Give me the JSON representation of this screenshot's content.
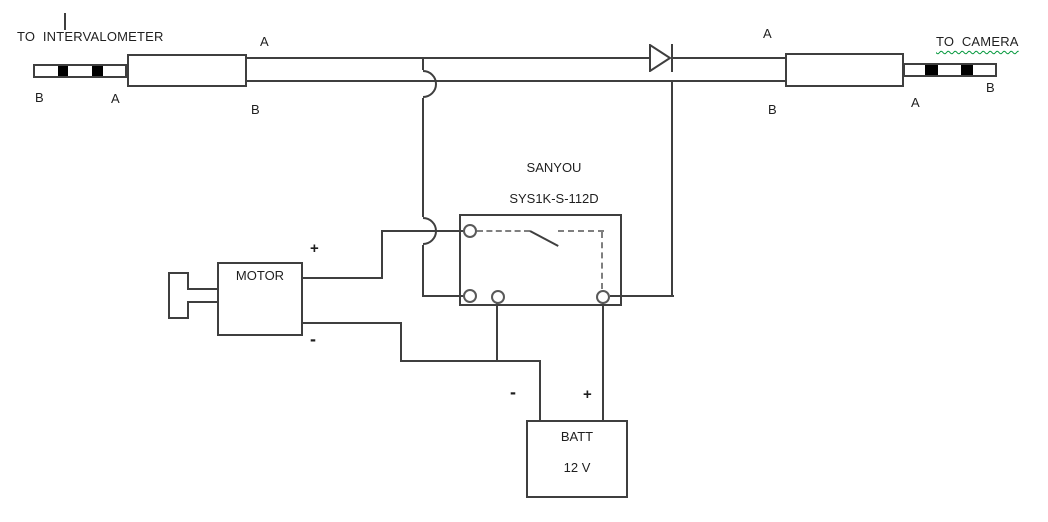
{
  "colors": {
    "line": "#3f3f3f",
    "dash": "#7f7f7f",
    "text": "#1f1f1f",
    "spellcheck_underline": "#009639",
    "plug_band": "#000000"
  },
  "header": {
    "left_caption": "TO  INTERVALOMETER",
    "right_caption": "TO  CAMERA"
  },
  "wire_labels": {
    "plug_left_b": "B",
    "plug_left_a": "A",
    "left_wire_a": "A",
    "left_wire_b": "B",
    "right_wire_a": "A",
    "right_wire_b": "B",
    "plug_right_a": "A",
    "plug_right_b": "B"
  },
  "relay": {
    "brand": "SANYOU",
    "model": "SYS1K-S-112D"
  },
  "motor": {
    "name": "MOTOR",
    "positive": "+",
    "negative": "-"
  },
  "battery": {
    "name": "BATT",
    "voltage": "12 V",
    "positive": "+",
    "negative": "-"
  }
}
